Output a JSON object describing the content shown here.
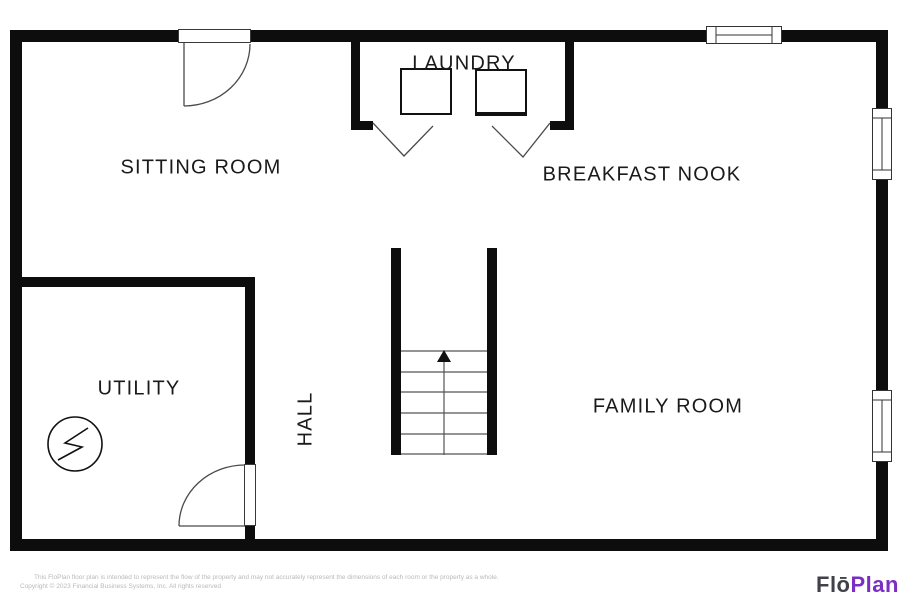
{
  "rooms": [
    {
      "id": "sitting-room",
      "label": "SITTING ROOM"
    },
    {
      "id": "laundry",
      "label": "LAUNDRY"
    },
    {
      "id": "breakfast-nook",
      "label": "BREAKFAST NOOK"
    },
    {
      "id": "utility",
      "label": "UTILITY"
    },
    {
      "id": "hall",
      "label": "HALL"
    },
    {
      "id": "family-room",
      "label": "FAMILY ROOM"
    }
  ],
  "symbols": {
    "stairs_arrow": "up-arrow-icon",
    "utility_circle": "electrical-bolt-icon",
    "doors": [
      "swing-door-icon",
      "swing-door-icon",
      "bifold-door-icon",
      "bifold-door-icon"
    ],
    "windows": 3,
    "appliances": [
      "washer",
      "dryer"
    ]
  },
  "footer": {
    "disclaimer": "This FloPlan floor plan is intended to represent the flow of the property and may not accurately represent the dimensions of each room or the property as a whole.",
    "copyright": "Copyright © 2023 Financial Business Systems, Inc. All rights reserved",
    "logo_flo": "Flō",
    "logo_plan": "Plan"
  },
  "colors": {
    "wall": "#0d0d0d",
    "background": "#ffffff",
    "label_text": "#1a1a1a",
    "thin_line": "#4a4a4a",
    "footer_text": "#b9b9b9",
    "logo_flo": "#41414b",
    "logo_plan": "#7b2fc2"
  }
}
